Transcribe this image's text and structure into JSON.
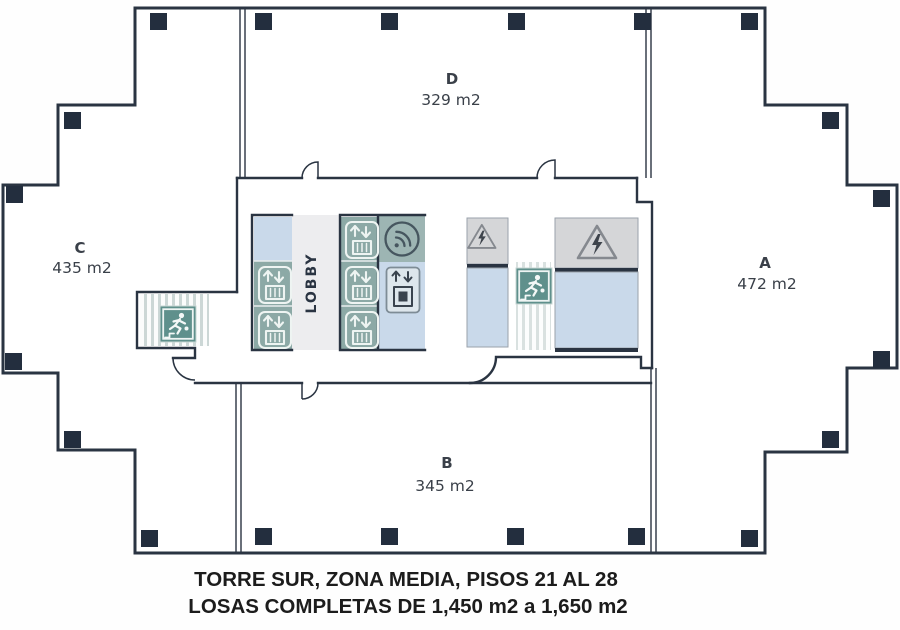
{
  "caption": {
    "line1": "TORRE SUR, ZONA MEDIA, PISOS 21 AL 28",
    "line2": "LOSAS COMPLETAS DE 1,450 m2 a 1,650 m2"
  },
  "sections": {
    "a": {
      "label": "A",
      "area": "472 m2"
    },
    "b": {
      "label": "B",
      "area": "345 m2"
    },
    "c": {
      "label": "C",
      "area": "435 m2"
    },
    "d": {
      "label": "D",
      "area": "329 m2"
    }
  },
  "core": {
    "lobby_label": "LOBBY"
  },
  "icons": {
    "passenger_elevator": "elevator-icon",
    "service_elevator": "service-elevator-icon",
    "wifi": "wifi-signal-icon",
    "high_voltage": "high-voltage-warning-icon",
    "emergency_exit": "emergency-exit-stairs-icon"
  },
  "colors": {
    "wall": "#2a3442",
    "column": "#232e3e",
    "teal": "#8ca9a6",
    "teal_muted": "#9db5b3",
    "teal_dark": "#5f908c",
    "light_blue": "#c9d9ea",
    "gray_room": "#d5d6d8",
    "lobby_bg": "#ededef",
    "stripe": "#ccd7d6",
    "text": "#3a4049",
    "caption_text": "#1c1c1c"
  }
}
